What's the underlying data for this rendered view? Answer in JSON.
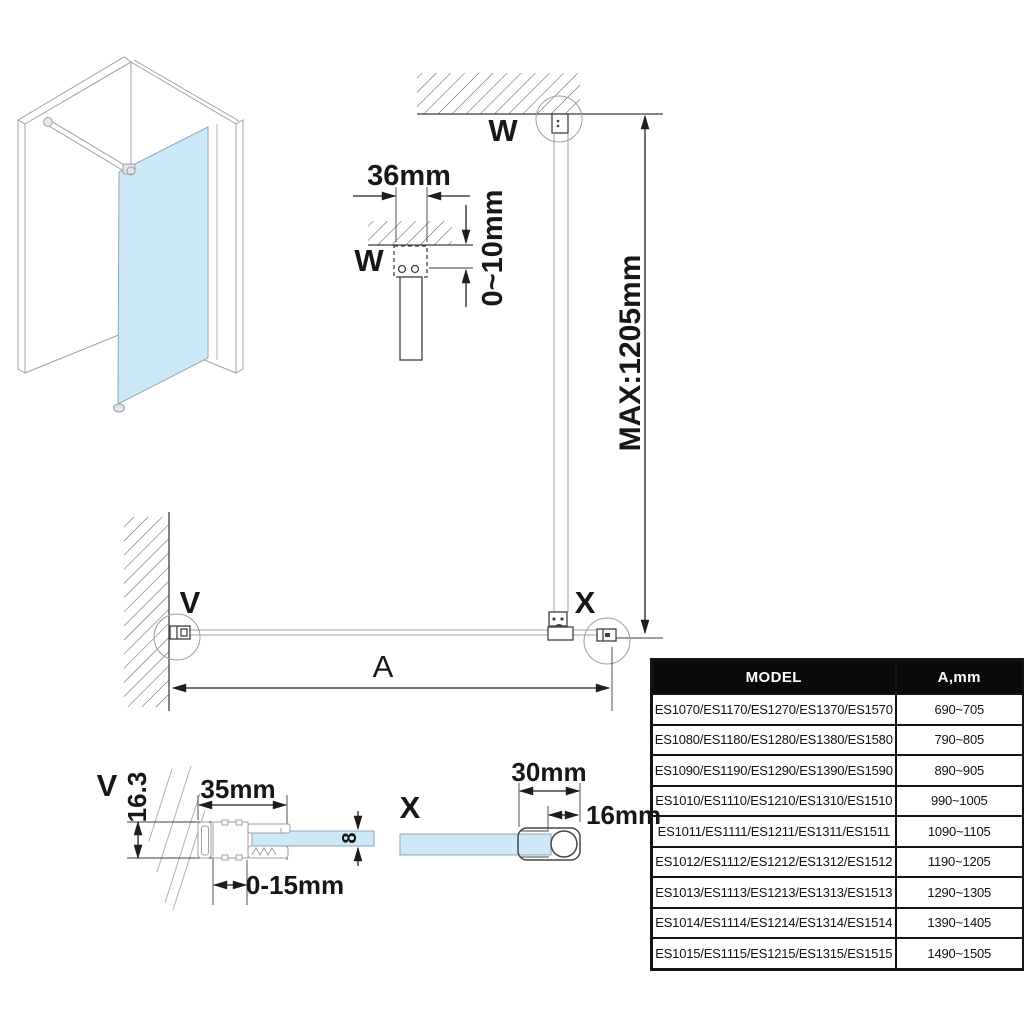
{
  "page": {
    "background_color": "#ffffff"
  },
  "colors": {
    "glass_blue": "#cde9f7",
    "drawing_line": "#3f3f3f",
    "light_line": "#98a0a8",
    "dimension_line": "#1d1d1d",
    "table_header_bg": "#0a0a0a",
    "table_header_text": "#ffffff",
    "table_border": "#141414"
  },
  "views": {
    "detail_w": {
      "label": "W",
      "width_dim": "36mm",
      "gap_dim": "0~10mm"
    },
    "elevation": {
      "label": "W",
      "max_height_dim": "MAX:1205mm"
    },
    "plan": {
      "wall_label": "V",
      "bar_label": "X",
      "width_dim": "A"
    },
    "detail_v": {
      "label": "V",
      "depth_dim": "16.3",
      "width_dim": "35mm",
      "glass_thickness_dim": "8",
      "adjust_dim": "0-15mm"
    },
    "detail_x": {
      "label": "X",
      "clamp_dim": "30mm",
      "bar_dim": "16mm"
    }
  },
  "table": {
    "headers": [
      "MODEL",
      "A,mm"
    ],
    "rows": [
      {
        "model": "ES1070/ES1170/ES1270/ES1370/ES1570",
        "a": "690~705"
      },
      {
        "model": "ES1080/ES1180/ES1280/ES1380/ES1580",
        "a": "790~805"
      },
      {
        "model": "ES1090/ES1190/ES1290/ES1390/ES1590",
        "a": "890~905"
      },
      {
        "model": "ES1010/ES1110/ES1210/ES1310/ES1510",
        "a": "990~1005"
      },
      {
        "model": "ES1011/ES1111/ES1211/ES1311/ES1511",
        "a": "1090~1105"
      },
      {
        "model": "ES1012/ES1112/ES1212/ES1312/ES1512",
        "a": "1190~1205"
      },
      {
        "model": "ES1013/ES1113/ES1213/ES1313/ES1513",
        "a": "1290~1305"
      },
      {
        "model": "ES1014/ES1114/ES1214/ES1314/ES1514",
        "a": "1390~1405"
      },
      {
        "model": "ES1015/ES1115/ES1215/ES1315/ES1515",
        "a": "1490~1505"
      }
    ]
  }
}
